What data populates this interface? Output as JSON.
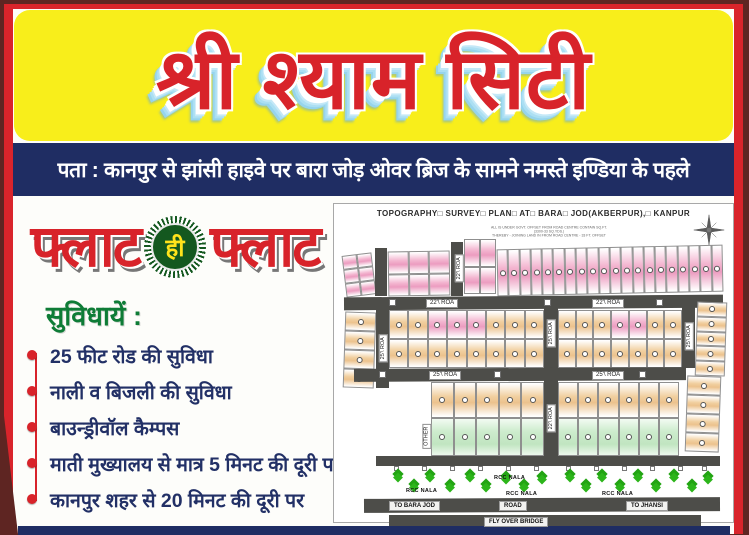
{
  "poster": {
    "title": "श्री श्याम सिटी",
    "address_line": "पता : कानपुर से झांसी हाइवे पर बारा जोड़ ओवर ब्रिज के सामने नमस्ते इण्डिया के पहले",
    "tagline": {
      "word_left": "फ्लाट",
      "badge": "ही",
      "word_right": "फ्लाट"
    },
    "amenities_heading": "सुविधायें :",
    "amenities": [
      "25 फीट रोड की सुविधा",
      "नाली व बिजली की सुविधा",
      "बाउन्ड्रीवॉल कैम्पस",
      "माती मुख्यालय से मात्र 5 मिनट की दूरी पर",
      "कानपुर शहर से 20 मिनट की दूरी पर"
    ],
    "colors": {
      "frame_red": "#d9242b",
      "outer_maroon": "#5e2522",
      "banner_yellow": "#f8ee1b",
      "navy": "#1f2d63",
      "title_red": "#d8232a",
      "heading_green": "#0e7c36",
      "badge_green": "#14581f",
      "badge_text_yellow": "#ffe31b"
    }
  },
  "map": {
    "title": "TOPOGRAPHY□ SURVEY□ PLAN□ AT□ BARA□ JOD(AKBERPUR),□ KANPUR",
    "notes": [
      "ALL IS UNDER GOVT. OFFSET FROM ROAD CENTRE CONTAIN SQ.FT. (3300-33 SQ.YDS.)",
      "THEREBY - JOINING LAND IN FROM ROAD CENTRE - 33 FT. OFFSET"
    ],
    "labels": {
      "h_road_top": "22'\\ ROA",
      "h_road_mid": "25'\\ ROA",
      "v_top": "22'\\ ROA",
      "v_left": "25'\\ ROA",
      "v_mid": "25'\\ ROA",
      "v_center": "22'\\ ROA",
      "v_right": "25'\\ ROA",
      "other": "OTHER",
      "rcc_nala": "RCC NALA",
      "to_left": "TO BARA JOD",
      "road": "ROAD",
      "to_right": "TO JHANSI",
      "flyover": "FLY OVER BRIDGE"
    },
    "colors": {
      "plot_pink": "#ec9cc0",
      "plot_tan": "#ecc28d",
      "plot_green": "#c1e5c1",
      "road_dark": "#4d4d49",
      "tree_green": "#22a413"
    }
  }
}
